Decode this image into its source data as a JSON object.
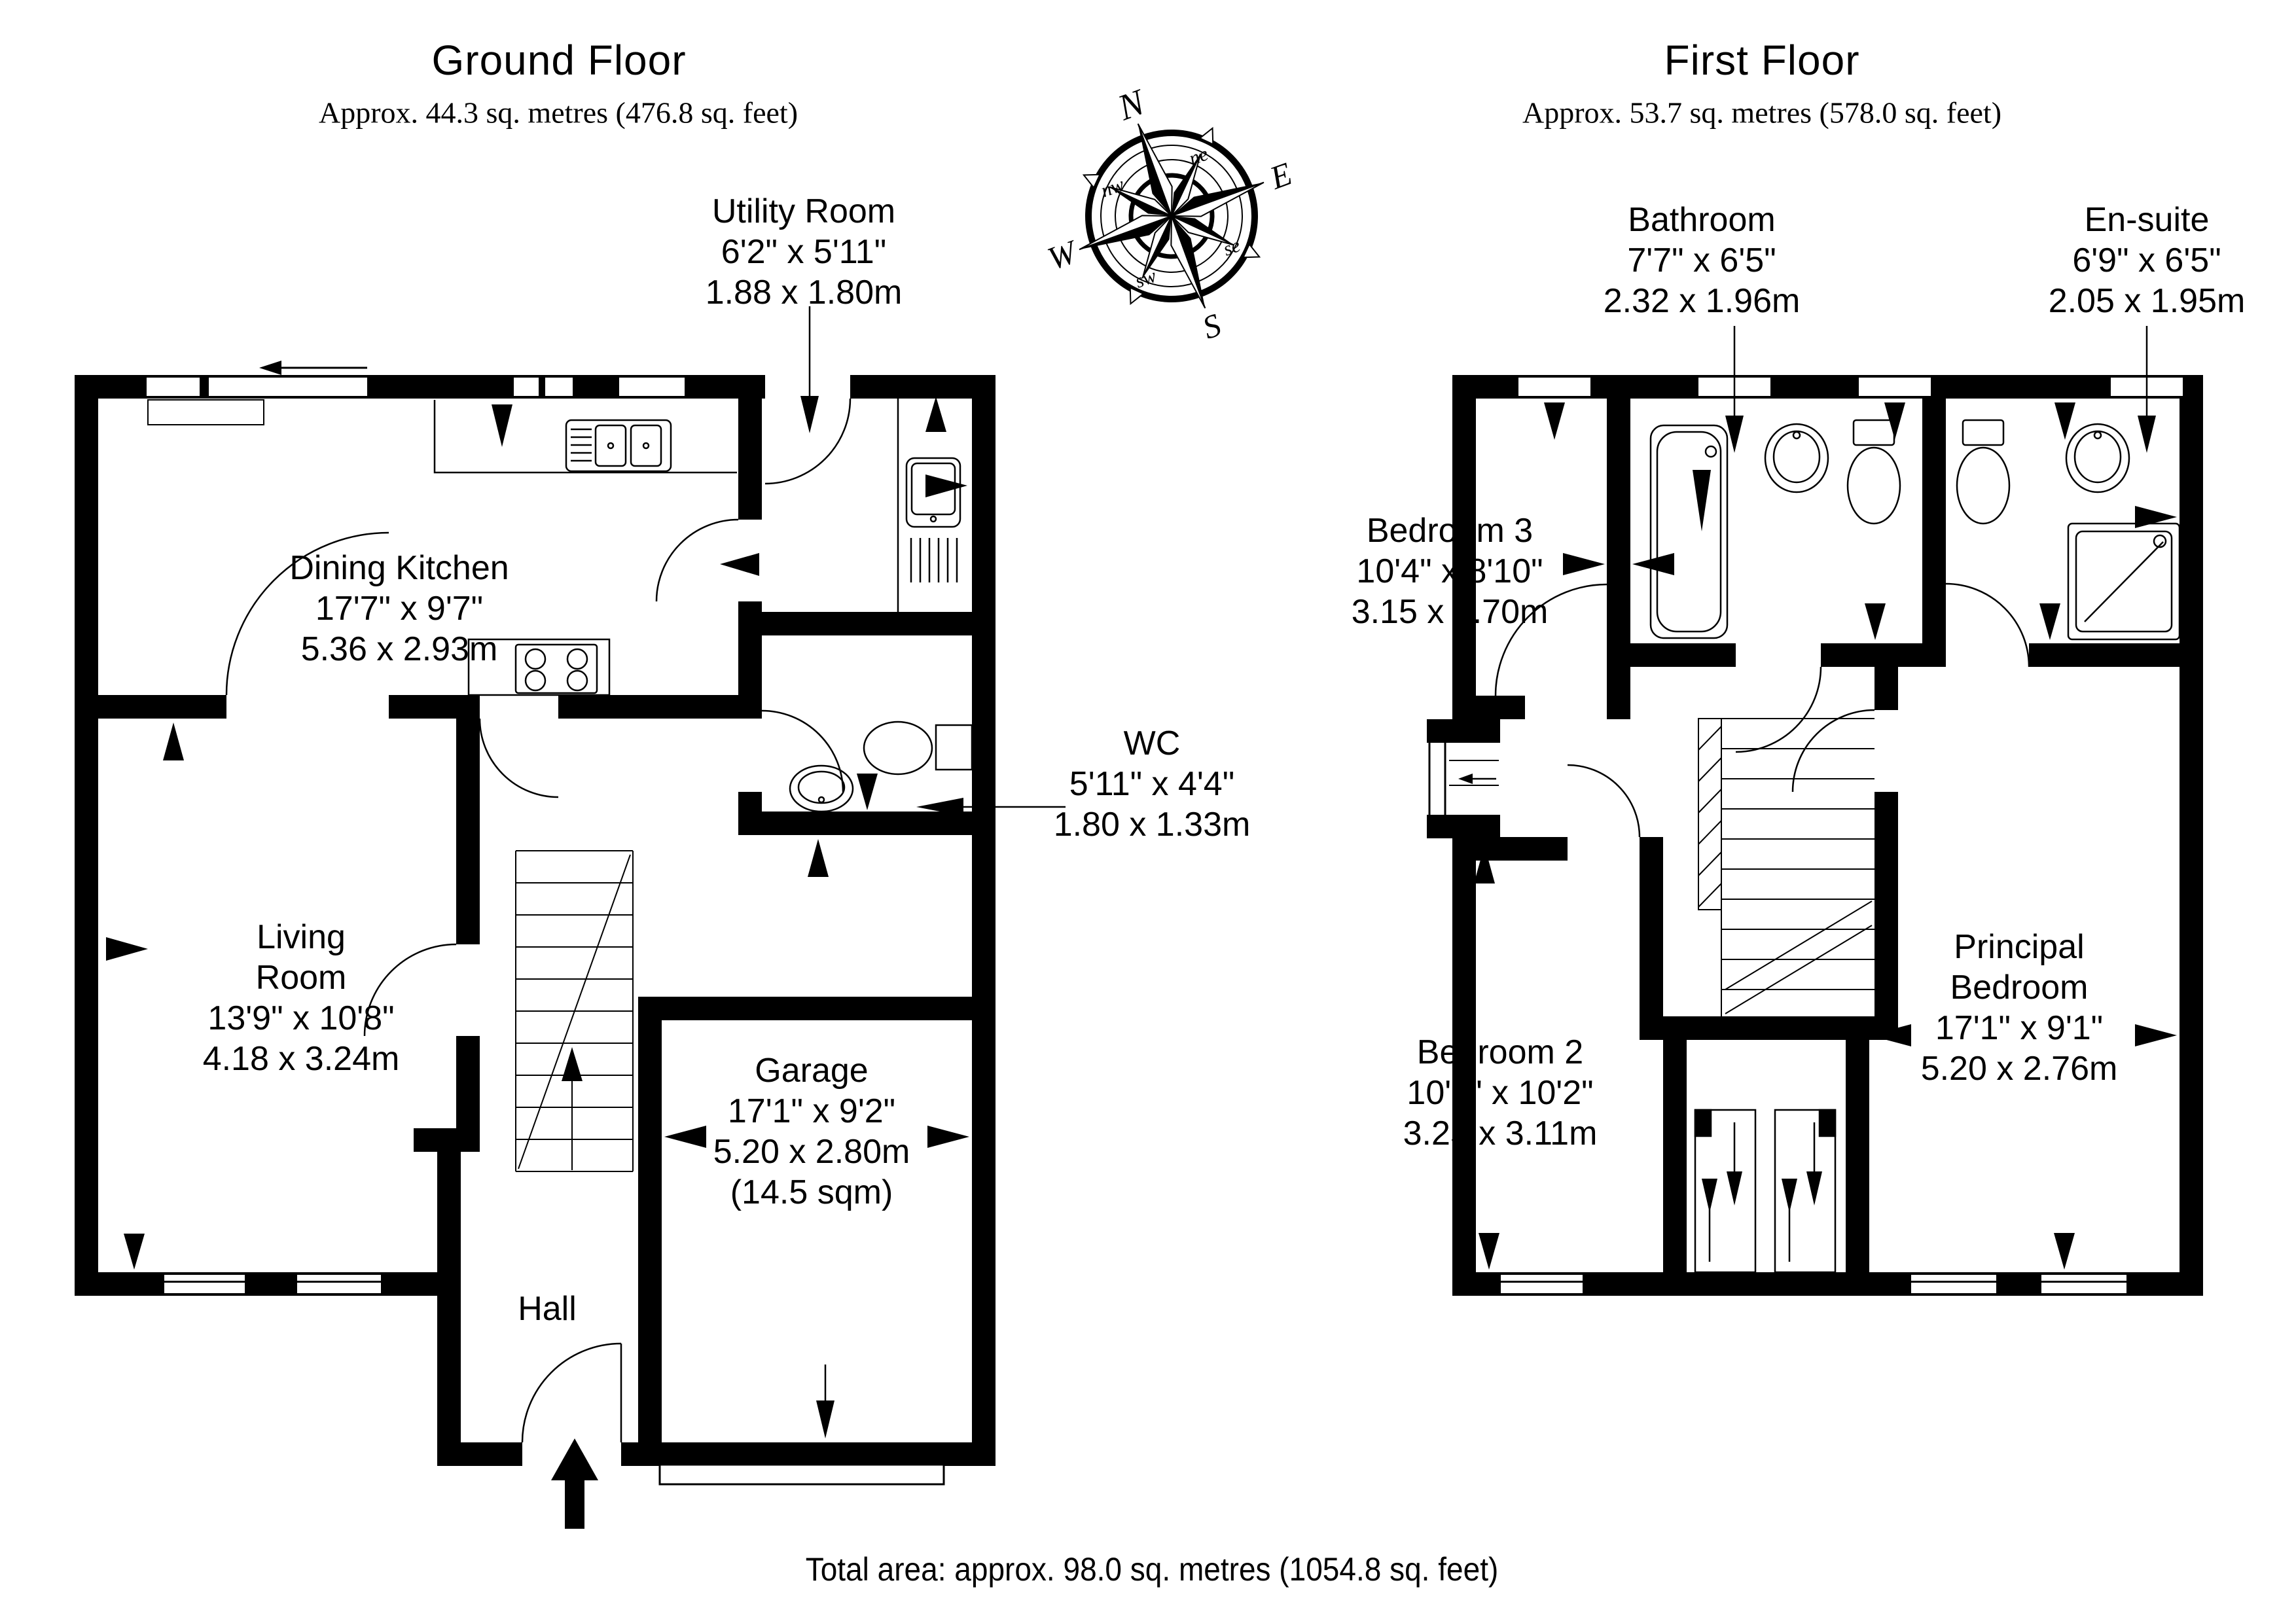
{
  "ground_floor": {
    "title": "Ground Floor",
    "subtitle": "Approx. 44.3 sq. metres (476.8 sq. feet)",
    "rooms": {
      "dining_kitchen": {
        "name": "Dining Kitchen",
        "imperial": "17'7\" x 9'7\"",
        "metric": "5.36 x 2.93m"
      },
      "utility": {
        "name": "Utility Room",
        "imperial": "6'2\" x 5'11\"",
        "metric": "1.88 x 1.80m"
      },
      "wc": {
        "name": "WC",
        "imperial": "5'11\" x 4'4\"",
        "metric": "1.80 x 1.33m"
      },
      "living_room": {
        "name": "Living Room",
        "imperial": "13'9\" x 10'8\"",
        "metric": "4.18 x 3.24m"
      },
      "garage": {
        "name": "Garage",
        "imperial": "17'1\" x 9'2\"",
        "metric": "5.20 x 2.80m",
        "area": "(14.5 sqm)"
      },
      "hall": {
        "name": "Hall"
      }
    }
  },
  "first_floor": {
    "title": "First Floor",
    "subtitle": "Approx. 53.7 sq. metres (578.0 sq. feet)",
    "rooms": {
      "bathroom": {
        "name": "Bathroom",
        "imperial": "7'7\" x 6'5\"",
        "metric": "2.32 x 1.96m"
      },
      "ensuite": {
        "name": "En-suite",
        "imperial": "6'9\" x 6'5\"",
        "metric": "2.05 x 1.95m"
      },
      "bedroom3": {
        "name": "Bedroom 3",
        "imperial": "10'4\" x 8'10\"",
        "metric": "3.15 x 2.70m"
      },
      "bedroom2": {
        "name": "Bedroom 2",
        "imperial": "10'8\" x 10'2\"",
        "metric": "3.25 x 3.11m"
      },
      "principal": {
        "name": "Principal Bedroom",
        "imperial": "17'1\" x 9'1\"",
        "metric": "5.20 x 2.76m"
      }
    }
  },
  "compass": {
    "n": "N",
    "e": "E",
    "s": "S",
    "w": "W",
    "ne": "ne",
    "se": "se",
    "sw": "sw",
    "nw": "nw"
  },
  "footer": {
    "total_area": "Total area: approx. 98.0 sq. metres (1054.8 sq. feet)"
  }
}
